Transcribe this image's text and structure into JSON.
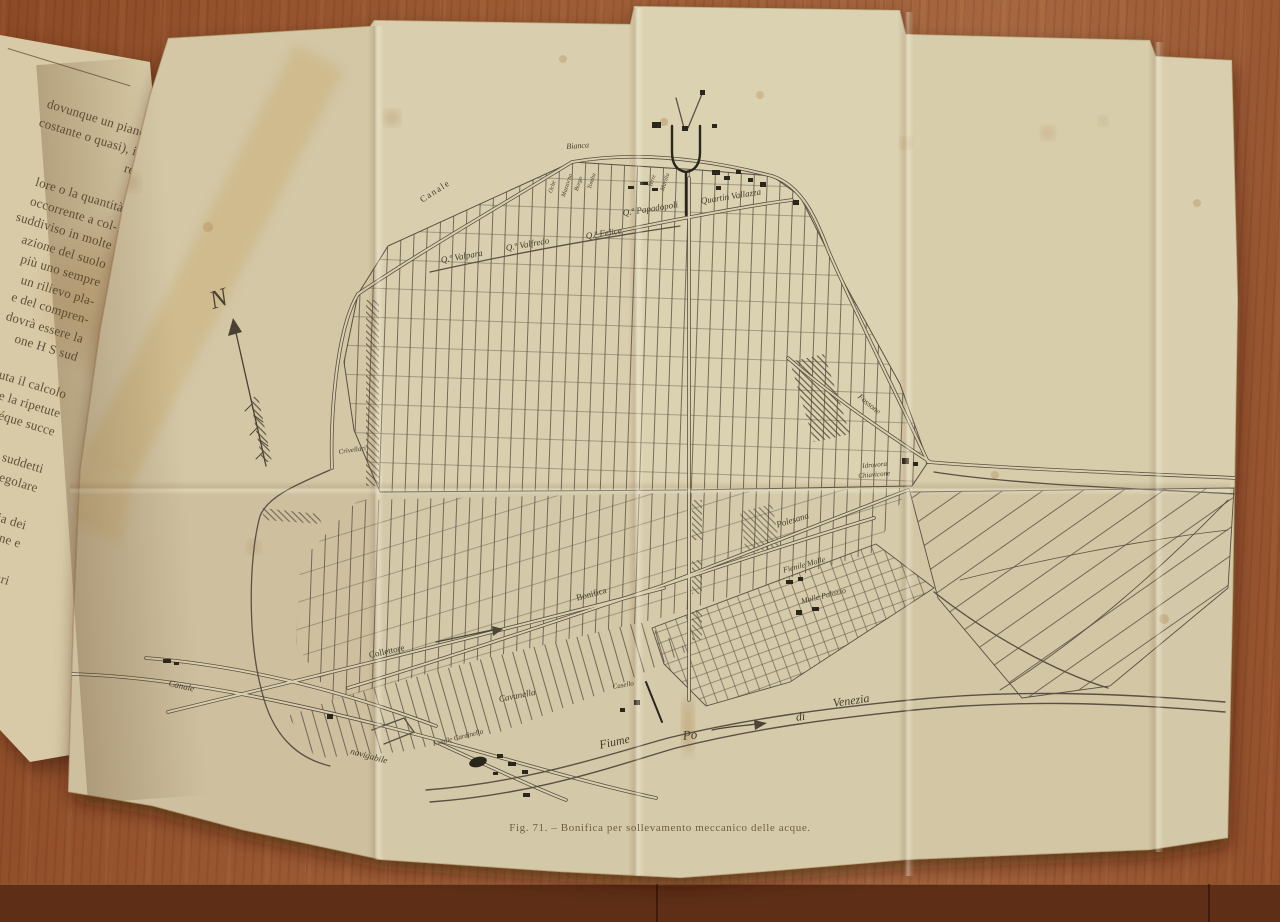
{
  "book": {
    "page_text": "dovunque un piano\ncostante o quasi), il\nre\n\nlore o la quantità\noccorrente a col-\nsuddiviso in molte\nazione del suolo\npiù uno sempre\nun rilievo pla-\ne del compren-\ndovrà essere la\none H S sud\n\nuta il calcolo\ne la ripetute\néque succe\n\nsi suddetti\nla regolare\n\nedia dei\nagione e\n\nra vari\n\nq., nel\nmisu-\nsente\nranco-\nale di\nè al",
    "page_number": "16"
  },
  "map": {
    "caption": "Fig. 71. – Bonifica per sollevamento meccanico delle acque.",
    "compass_north_label": "N",
    "labels": {
      "canale_nw": "Canale",
      "bianca": "Bianca",
      "q_valpara": "Q.º Valpara",
      "q_valfredo": "Q.º Valfredo",
      "q_felice": "Q.º Felice",
      "q_papadopoli": "Q.º Papadopoli",
      "quartin_vallazza": "Quartin Vallazza",
      "crivellari": "Crivellari",
      "fossone": "Fossone",
      "idrovora": "Idrovora",
      "chiavicone": "Chiavicone",
      "polesana": "Polesana",
      "fienile_molle": "Fienile Molle",
      "molle_palazzo": "Molle Palazzo",
      "bonifica": "Bonifica",
      "collettore": "Collettore",
      "cavanella": "Cavanella",
      "casello": "Casello",
      "fienile_cardinella": "Fienile Cardinella",
      "canale_sw": "Canale",
      "navigabile": "navigabile",
      "fiume": "Fiume",
      "po": "Po",
      "di": "di",
      "venezia": "Venezia",
      "farm_1": "Oche",
      "farm_2": "Mazzorno",
      "farm_3": "Borgo",
      "farm_4": "Tomba",
      "farm_5": "Terre",
      "farm_6": "Marilla"
    }
  },
  "colors": {
    "paper": "#d9cfae",
    "ink": "#5a5043",
    "wood": "#9c5a33",
    "foxing": "#a97c42"
  }
}
